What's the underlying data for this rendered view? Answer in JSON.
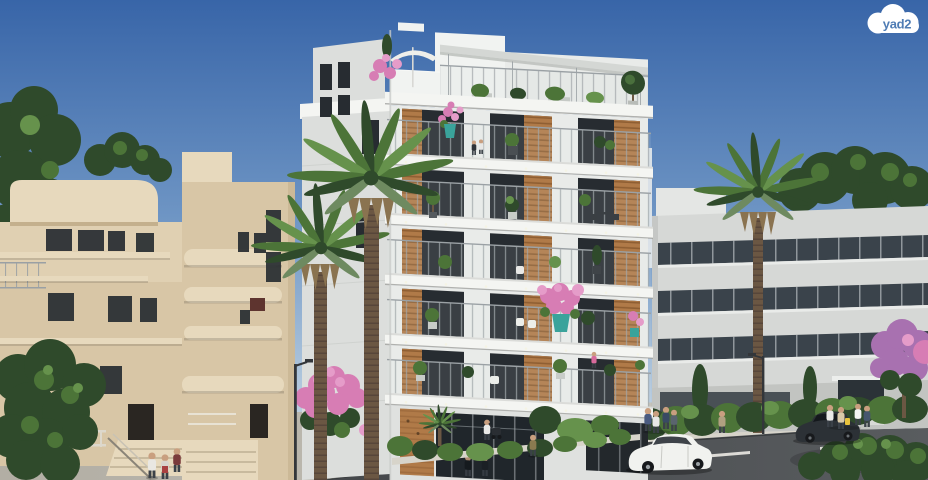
{
  "logo": {
    "text": "yad2"
  },
  "scene": {
    "type": "architectural-rendering",
    "subject": "new residential building street view with Bauhaus neighbors, palms, street and pedestrians"
  },
  "colors": {
    "sky-top": "#3865a8",
    "sky-mid": "#6e95c4",
    "sky-low": "#a7c0d9",
    "sky-horizon": "#d3dfe9",
    "new-face": "#e9ebe9",
    "new-face-light": "#f1f3f1",
    "new-side": "#dcdedc",
    "slab": "#f4f5f2",
    "window": "#272c31",
    "wood": "#b07a48",
    "wood-dark": "#8f5f33",
    "railing": "#9aa0a4",
    "pergola": "#d4d7d4",
    "beige": "#d8c6a6",
    "beige-light": "#e7d9bd",
    "beige-shadow": "#c4b08d",
    "right-face": "#d6d8d6",
    "right-top": "#e4e6e4",
    "ribbon": "#3a434b",
    "mullion": "#c9ced2",
    "green-dark": "#2f4a2b",
    "green-mid": "#4c7438",
    "green-light": "#66924c",
    "palm-gray": "#6e8a60",
    "trunk": "#6b5743",
    "trunk-dark": "#57463a",
    "dry-frond": "#8a7350",
    "pink": "#d77db4",
    "pink-light": "#e59cc9",
    "purple": "#a871b0",
    "turquoise": "#3aa39b",
    "road": "#45484b",
    "road-light": "#595c5f",
    "sidewalk": "#b2aea4",
    "sidewalk-light": "#c9c6bd",
    "curb": "#d7d4ca",
    "marking": "#eceae4",
    "car-white": "#f1f2ef",
    "car-dark": "#2c3136",
    "tire": "#17191c",
    "skin": "#c99f7f",
    "lamp": "#33363a",
    "logo-cloud": "#ffffff",
    "logo-text": "#4f7cb4"
  }
}
